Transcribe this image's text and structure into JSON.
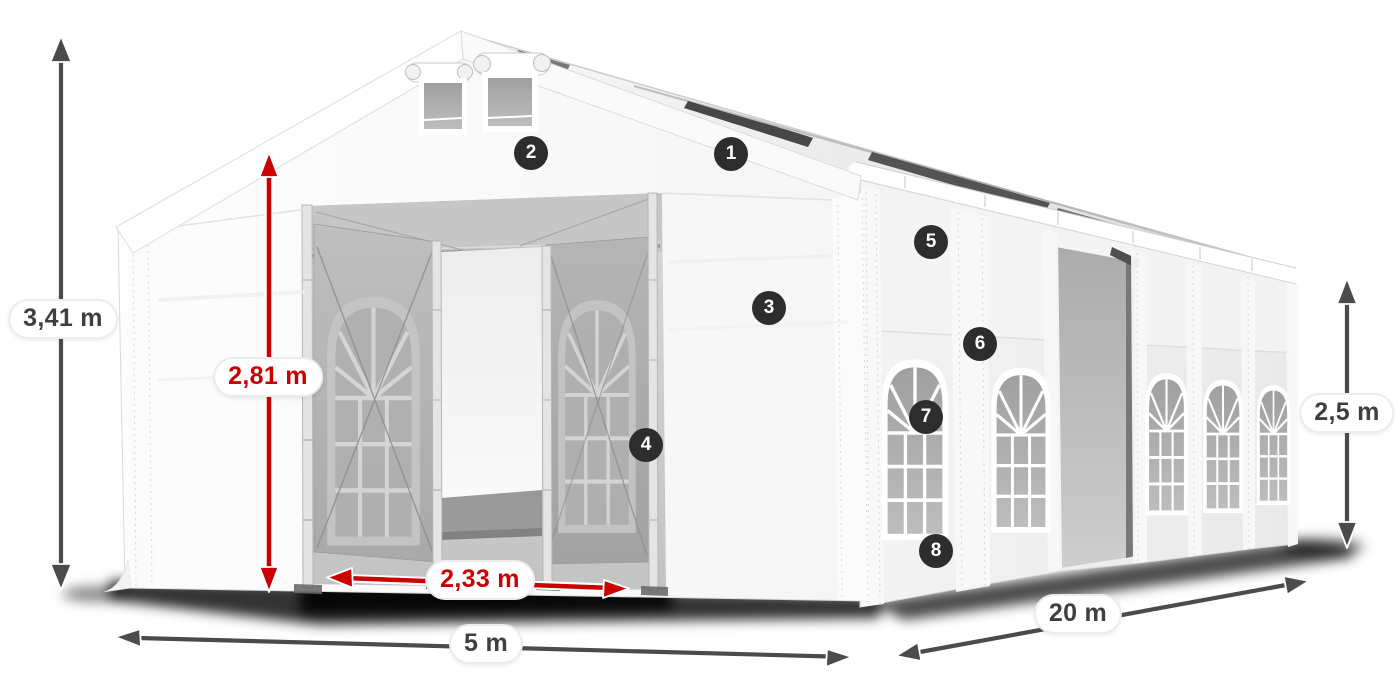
{
  "diagram": {
    "subject": "marquee-tent-dimension-diagram",
    "dimensions": [
      {
        "id": "total-height",
        "label": "3,41 m",
        "style": "gray"
      },
      {
        "id": "door-height",
        "label": "2,81 m",
        "style": "red"
      },
      {
        "id": "door-width",
        "label": "2,33 m",
        "style": "red"
      },
      {
        "id": "front-width",
        "label": "5 m",
        "style": "gray"
      },
      {
        "id": "side-length",
        "label": "20 m",
        "style": "gray"
      },
      {
        "id": "side-wall-height",
        "label": "2,5 m",
        "style": "gray"
      }
    ],
    "callouts": [
      "1",
      "2",
      "3",
      "4",
      "5",
      "6",
      "7",
      "8"
    ],
    "colors": {
      "dimension_red": "#cb0000",
      "dimension_gray": "#4b4b4b",
      "badge_background": "#2d2d2d",
      "badge_number": "#ffffff",
      "canvas_background": "#ffffff"
    }
  }
}
